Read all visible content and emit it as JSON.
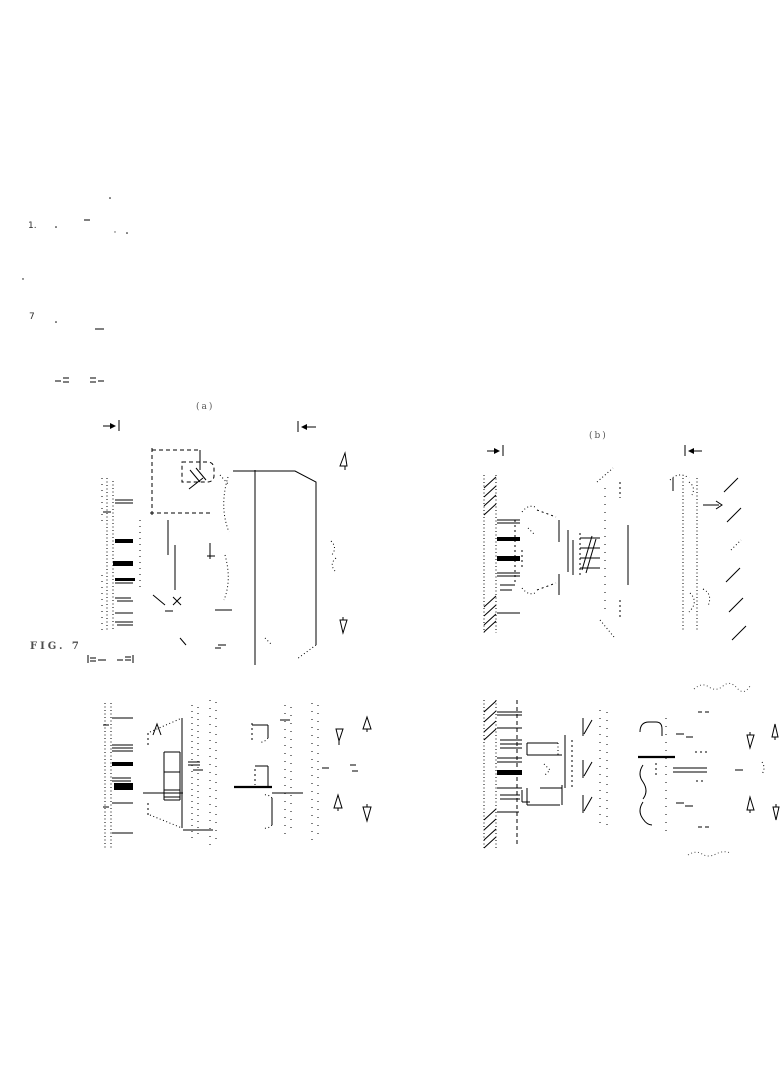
{
  "page": {
    "background_color": "#ffffff",
    "ink_color": "#000000"
  },
  "labels": {
    "panel_a": "(a)",
    "panel_b": "(b)",
    "figure_caption": "FIG. 7"
  },
  "stray_marks": {
    "mark_top": "1.",
    "mark_mid": "7"
  }
}
